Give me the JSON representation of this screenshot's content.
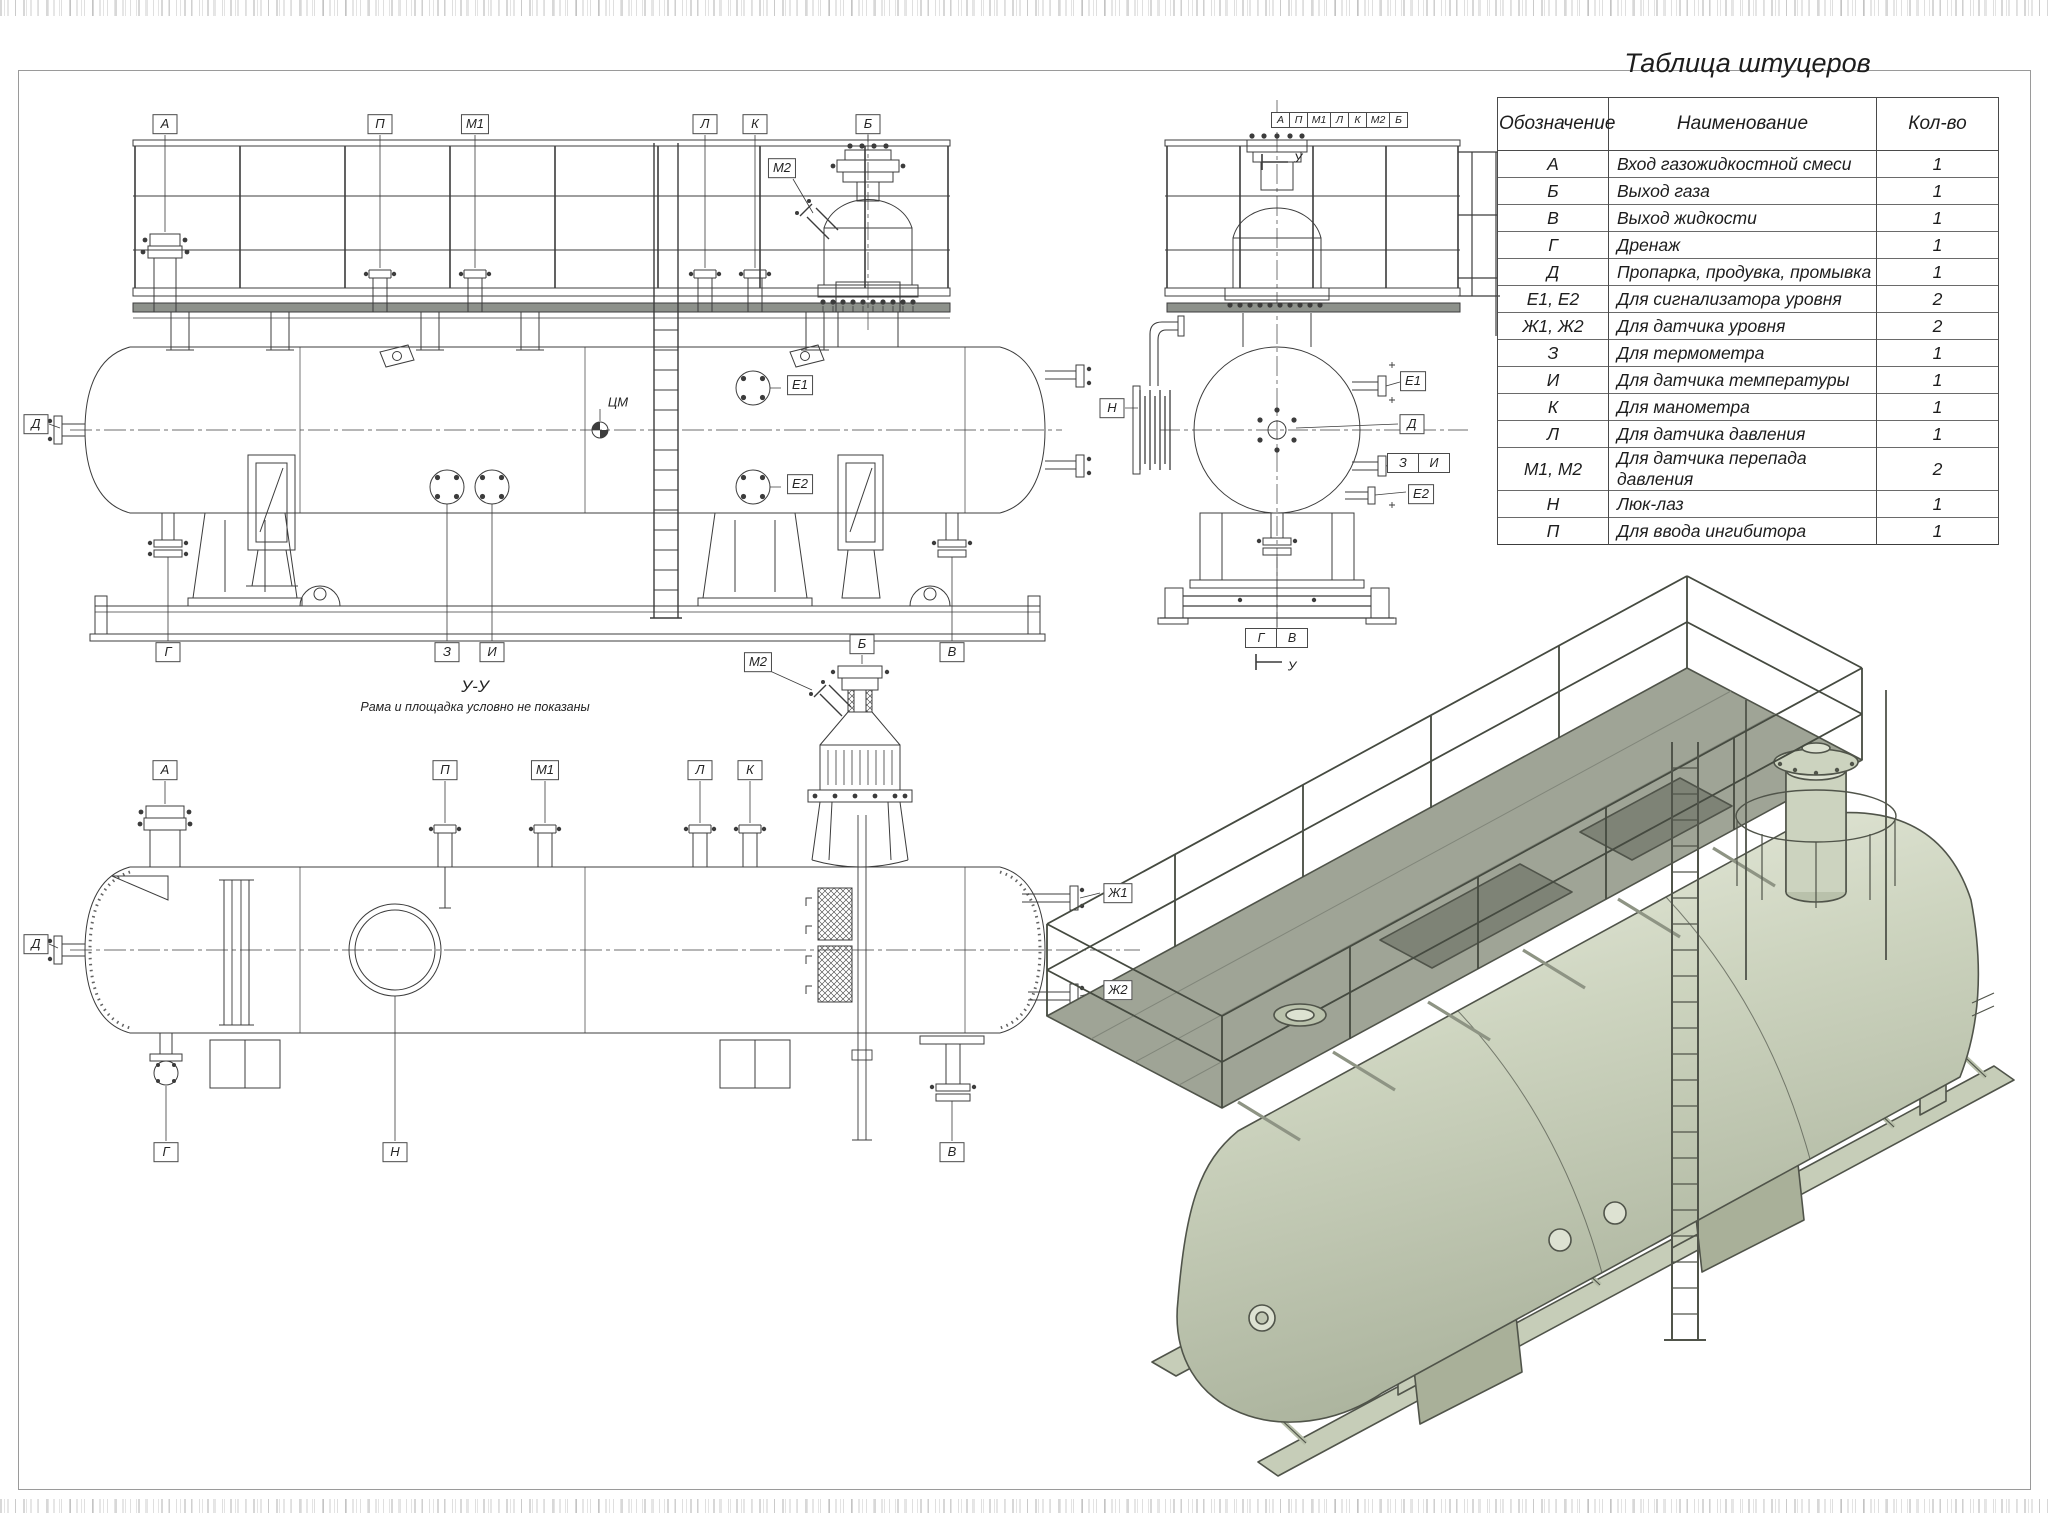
{
  "table": {
    "title": "Таблица штуцеров",
    "headers": {
      "designation": "Обозначение",
      "name": "Наименование",
      "qty": "Кол-во"
    },
    "rows": [
      {
        "designation": "А",
        "name": "Вход газожидкостной смеси",
        "qty": "1"
      },
      {
        "designation": "Б",
        "name": "Выход газа",
        "qty": "1"
      },
      {
        "designation": "В",
        "name": "Выход жидкости",
        "qty": "1"
      },
      {
        "designation": "Г",
        "name": "Дренаж",
        "qty": "1"
      },
      {
        "designation": "Д",
        "name": "Пропарка, продувка, промывка",
        "qty": "1"
      },
      {
        "designation": "Е1, Е2",
        "name": "Для сигнализатора  уровня",
        "qty": "2"
      },
      {
        "designation": "Ж1, Ж2",
        "name": "Для датчика уровня",
        "qty": "2"
      },
      {
        "designation": "З",
        "name": "Для термометра",
        "qty": "1"
      },
      {
        "designation": "И",
        "name": "Для датчика температуры",
        "qty": "1"
      },
      {
        "designation": "К",
        "name": "Для манометра",
        "qty": "1"
      },
      {
        "designation": "Л",
        "name": "Для датчика давления",
        "qty": "1"
      },
      {
        "designation": "М1, М2",
        "name": "Для датчика перепада давления",
        "qty": "2"
      },
      {
        "designation": "Н",
        "name": "Люк-лаз",
        "qty": "1"
      },
      {
        "designation": "П",
        "name": "Для ввода ингибитора",
        "qty": "1"
      }
    ]
  },
  "side_view": {
    "labels": {
      "a": "А",
      "p": "П",
      "m1": "М1",
      "l": "Л",
      "k": "К",
      "b": "Б",
      "m2": "М2",
      "d": "Д",
      "e1": "Е1",
      "e2": "Е2",
      "g": "Г",
      "z": "З",
      "i": "И",
      "v": "В"
    },
    "cm_mark": "ЦМ"
  },
  "end_view": {
    "header": [
      "А",
      "П",
      "М1",
      "Л",
      "К",
      "М2",
      "Б"
    ],
    "view_arrow": "У",
    "view_arrow_bottom": "У",
    "labels": {
      "n": "Н",
      "e1": "Е1",
      "d": "Д",
      "z": "З",
      "i": "И",
      "e2": "Е2",
      "g": "Г",
      "v": "В"
    }
  },
  "top_view": {
    "title": "У-У",
    "note": "Рама и площадка условно не показаны",
    "labels": {
      "a": "А",
      "p": "П",
      "m1": "М1",
      "l": "Л",
      "k": "К",
      "m2": "М2",
      "b": "Б",
      "d": "Д",
      "g": "Г",
      "n": "Н",
      "v": "В",
      "zh1": "Ж1",
      "zh2": "Ж2"
    }
  },
  "colors": {
    "line": "#3c3c3c",
    "vessel_fill": "#ccd3bf",
    "deck_fill": "#9fa496",
    "frame": "#9a9a9a"
  }
}
